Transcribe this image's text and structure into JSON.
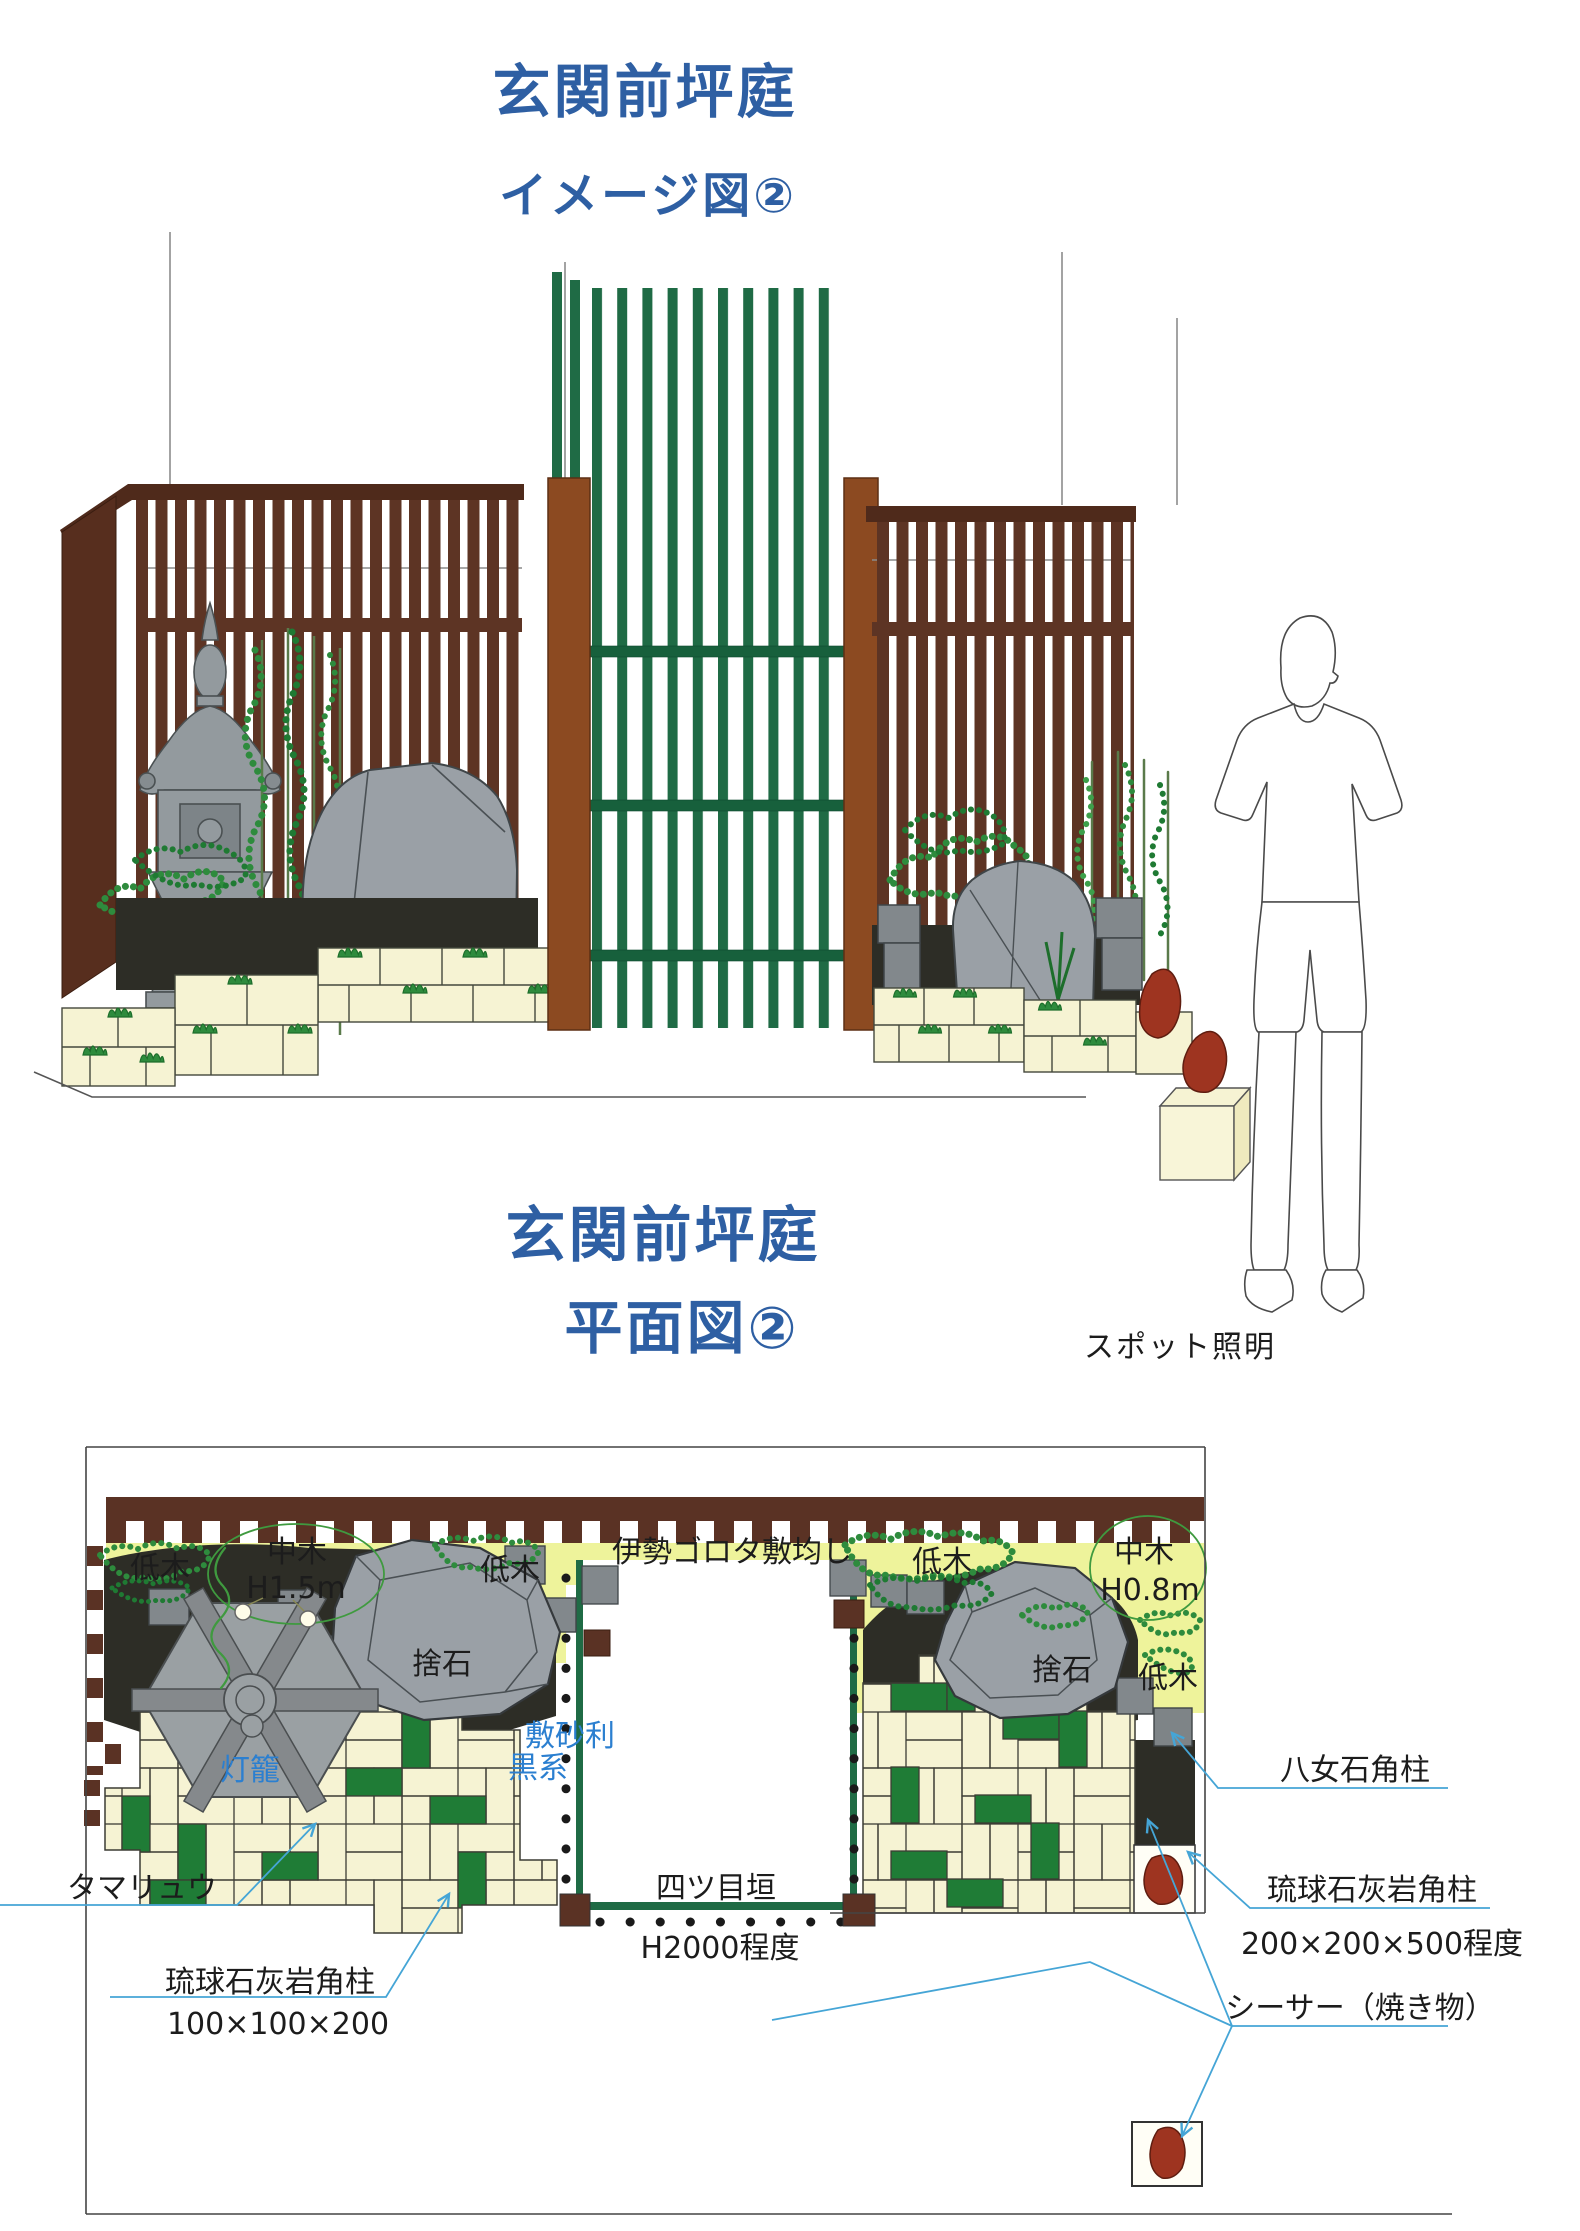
{
  "titles": {
    "image_view": {
      "line1": "玄関前坪庭",
      "line2": "イメージ図②"
    },
    "plan_view": {
      "line1": "玄関前坪庭",
      "line2": "平面図②"
    }
  },
  "plan": {
    "spot_lighting": "スポット照明",
    "labels": {
      "low_tree": "低木",
      "mid_tree": "中木",
      "mid_tree_height_left": "H1.5m",
      "mid_tree_height_right": "H0.8m",
      "ise_gorota": "伊勢ゴロタ敷均し",
      "suteishi": "捨石",
      "lantern": "灯籠",
      "gravel_line1": "敷砂利",
      "gravel_line2": "黒系",
      "yotsume_fence": "四ツ目垣",
      "yotsume_height": "H2000程度",
      "tamaryu": "タマリュウ",
      "ryukyu_pillar": "琉球石灰岩角柱",
      "ryukyu_small_size": "100×100×200",
      "ryukyu_large_size": "200×200×500程度",
      "yame_pillar": "八女石角柱",
      "shisa": "シーサー（焼き物）"
    }
  },
  "colors": {
    "title_blue": "#2e5fa3",
    "label_blue": "#2b7fd0",
    "leader_blue": "#45a5d6",
    "fence_brown": "#5d3424",
    "gate_post_brown": "#8c4a21",
    "gate_green": "#1f6b45",
    "rock_gray": "#9aa0a6",
    "paver_cream": "#f6f3d3",
    "paver_green": "#1f7c36",
    "gravel_dark": "#2d2d26",
    "plan_yellow": "#eef39b",
    "shisa_red": "#9e3420"
  }
}
